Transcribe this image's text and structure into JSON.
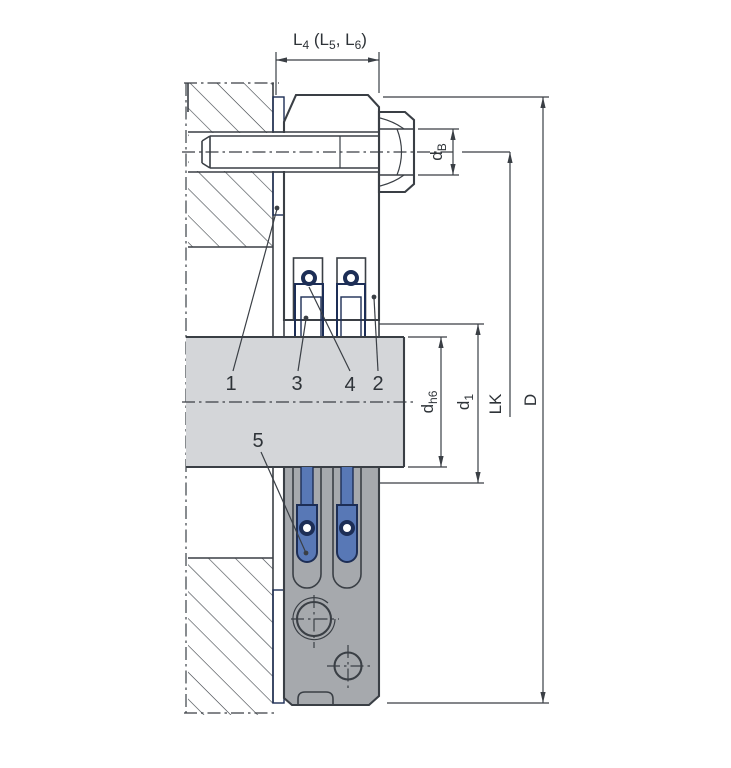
{
  "colors": {
    "line": "#3a3f45",
    "text": "#2e3338",
    "gray": "#a6a9ad",
    "hatch": "#42474d",
    "shaft": "#d4d6d9",
    "blue": "#5878b6",
    "bluedark": "#2c478a",
    "navy": "#1d2e56",
    "gasket": "#8ba3c9",
    "gasketline": "#3f5c94"
  },
  "dimensions": {
    "l4": {
      "p1": "L",
      "s1": "4",
      "p2": " (L",
      "s2": "5",
      "p3": ", L",
      "s3": "6",
      "p4": ")"
    },
    "db": {
      "base": "d",
      "sub": "B"
    },
    "dh6": {
      "base": "d",
      "sub": "h6"
    },
    "d1": {
      "base": "d",
      "sub": "1"
    },
    "lk": {
      "label": "LK"
    },
    "d_outer": {
      "label": "D"
    }
  },
  "callouts": {
    "c1": "1",
    "c2": "2",
    "c3": "3",
    "c4": "4",
    "c5": "5"
  }
}
